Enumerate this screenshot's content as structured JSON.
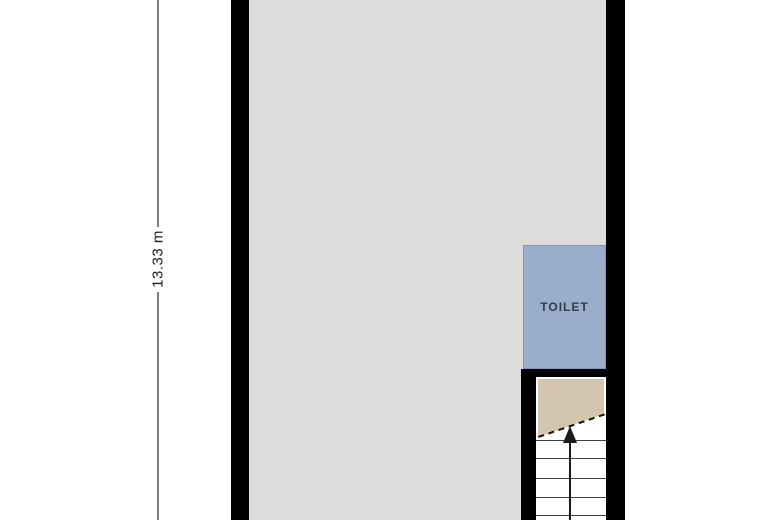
{
  "canvas": {
    "background": "#ffffff",
    "width": 780,
    "height": 520
  },
  "walls": {
    "color": "#000000"
  },
  "dimension": {
    "label": "13.33 m",
    "line_color": "#7d7d7d",
    "text_color": "#1c1c1c"
  },
  "rooms": {
    "main": {
      "floor_color": "#dcdcdc"
    },
    "toilet": {
      "label": "TOILET",
      "floor_color": "#9aaecc",
      "border_color": "#8496b5",
      "label_color": "#323c4b"
    }
  },
  "stairs": {
    "floor_color": "#ffffff",
    "landing_color": "#d3c5ae",
    "tread_color": "#3f3f3f",
    "tread_count": 5,
    "arrow_color": "#1c1c1c",
    "direction": "up",
    "cut_line_style": "dashed"
  }
}
